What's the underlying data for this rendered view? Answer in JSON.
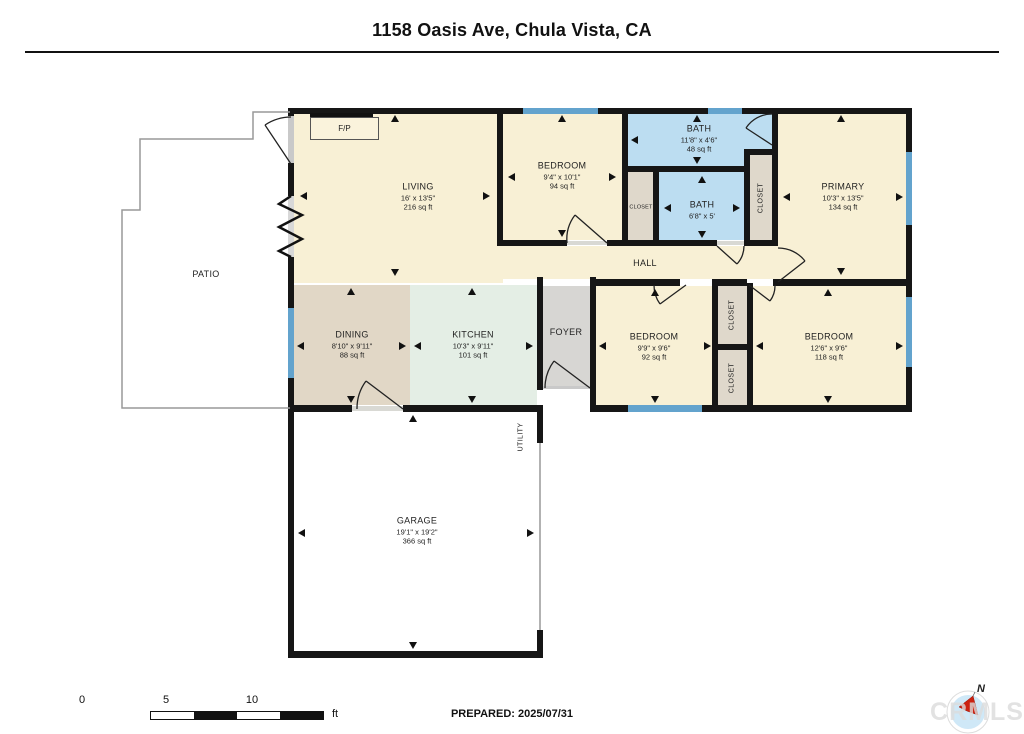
{
  "title": "1158 Oasis Ave, Chula Vista, CA",
  "rooms": {
    "living": {
      "name": "LIVING",
      "dims": "16' x 13'5\"",
      "area": "216 sq ft"
    },
    "bedroom_top": {
      "name": "BEDROOM",
      "dims": "9'4\" x 10'1\"",
      "area": "94 sq ft"
    },
    "bath_main": {
      "name": "BATH",
      "dims": "11'8\" x 4'6\"",
      "area": "48 sq ft"
    },
    "bath_small": {
      "name": "BATH",
      "dims": "6'8\" x 5'"
    },
    "primary": {
      "name": "PRIMARY",
      "dims": "10'3\" x 13'5\"",
      "area": "134 sq ft"
    },
    "hall": {
      "name": "HALL"
    },
    "dining": {
      "name": "DINING",
      "dims": "8'10\" x 9'11\"",
      "area": "88 sq ft"
    },
    "kitchen": {
      "name": "KITCHEN",
      "dims": "10'3\" x 9'11\"",
      "area": "101 sq ft"
    },
    "foyer": {
      "name": "FOYER"
    },
    "bedroom_left": {
      "name": "BEDROOM",
      "dims": "9'9\" x 9'6\"",
      "area": "92 sq ft"
    },
    "bedroom_right": {
      "name": "BEDROOM",
      "dims": "12'6\" x 9'6\"",
      "area": "118 sq ft"
    },
    "garage": {
      "name": "GARAGE",
      "dims": "19'1\" x 19'2\"",
      "area": "366 sq ft"
    },
    "patio": {
      "name": "PATIO"
    },
    "closet": {
      "name": "CLOSET"
    },
    "utility": {
      "name": "UTILITY"
    },
    "fireplace": {
      "name": "F/P"
    }
  },
  "footer": {
    "prepared": "PREPARED: 2025/07/31",
    "scale": {
      "ticks": [
        "0",
        "5",
        "10"
      ],
      "unit": "ft"
    },
    "compass": {
      "label": "N"
    },
    "watermark": "CRMLS"
  },
  "colors": {
    "wall": "#161616",
    "room_cream": "#F8F0D5",
    "bath_blue": "#BCDDF1",
    "dining_tan": "#E1D7C6",
    "kitchen_mint": "#E4EEE5",
    "foyer_gray": "#D7D6D3",
    "closet_fill": "#DFD8CB",
    "window_blue": "#63A3CD",
    "garage_white": "#FFFFFF",
    "compass_red": "#CC2211",
    "watermark_gray": "#DCDCDC"
  }
}
